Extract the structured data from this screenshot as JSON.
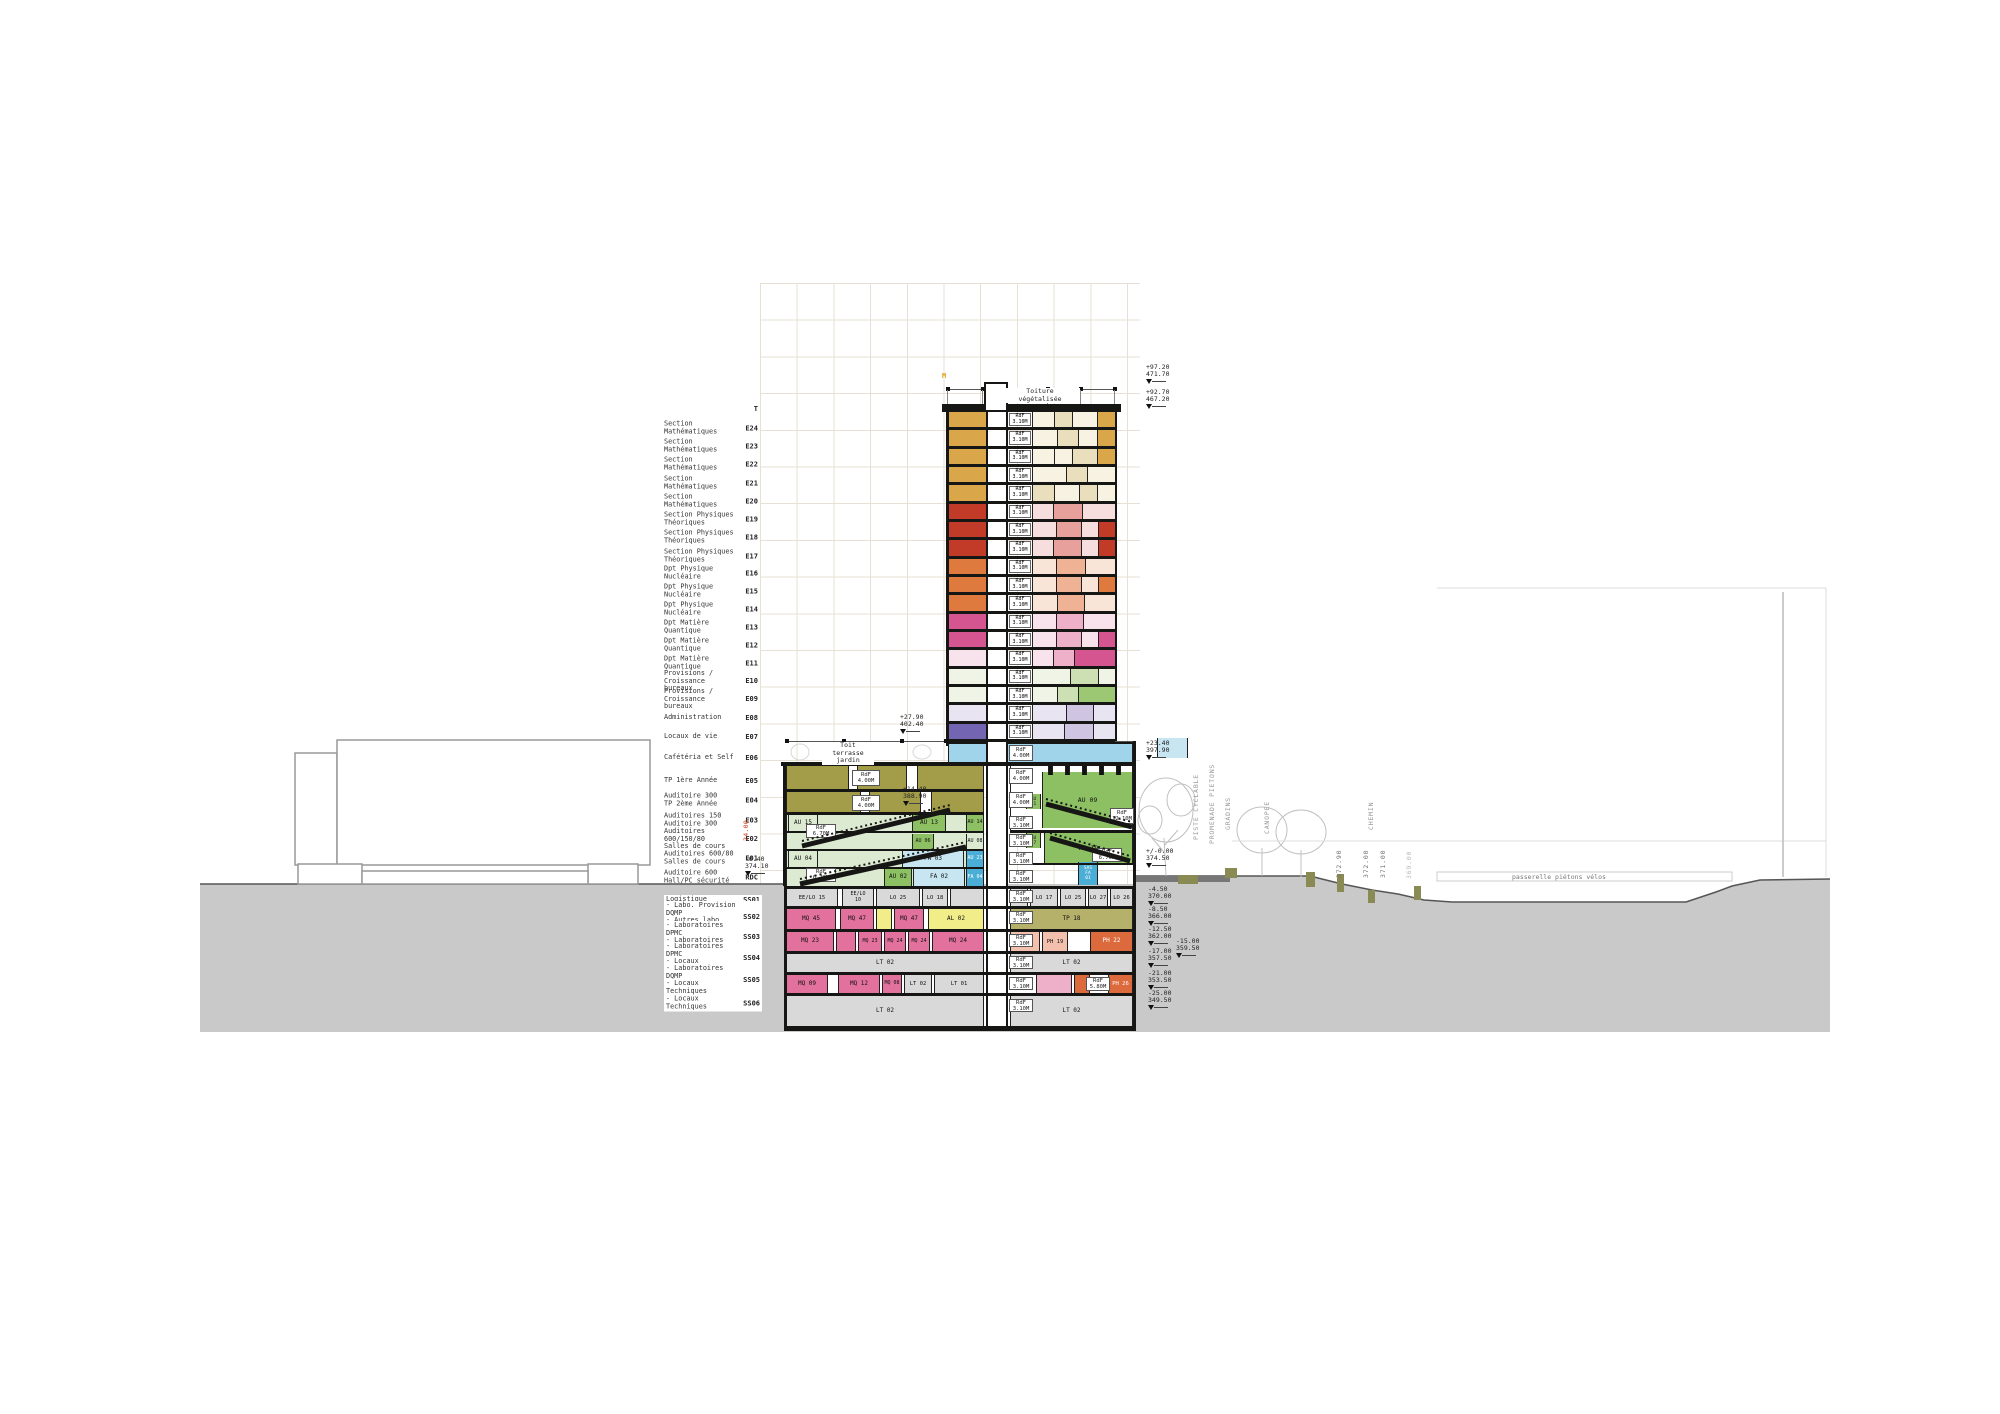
{
  "colors": {
    "gold": "#d9a64a",
    "tan": "#e9dfbc",
    "cream": "#f7f2e2",
    "red": "#c23a28",
    "rose": "#e7a09c",
    "pinkL": "#f7dede",
    "orange": "#df7a3e",
    "sal": "#f0b294",
    "salL": "#f9e4d8",
    "magenta": "#d45590",
    "pk": "#eeafc9",
    "pkL": "#f8e2ec",
    "green": "#9dc873",
    "grnM": "#cde0b4",
    "grnL": "#eff4e6",
    "lav": "#cfc5e2",
    "lavL": "#e8e4f2",
    "purple": "#7465b2",
    "blue": "#9fd4ea",
    "blueD": "#4aaed6",
    "blueM": "#c8e6f2",
    "olive": "#a39d4a",
    "oliveL": "#b5b06a",
    "paleGrn": "#dcead2",
    "auGreen": "#8cc063",
    "pinkLab": "#e2719d",
    "yellow": "#f1ee8a",
    "phOr": "#dd6a3d",
    "phSal": "#f2c0ac",
    "grayRoom": "#d9d9d9",
    "white": "#ffffff",
    "black": "#111111",
    "ground": "#c9c9c9",
    "accentOrange": "#e8a020",
    "dimRed": "#cc4422"
  },
  "floor_labels": [
    [
      409,
      "",
      "T"
    ],
    [
      428,
      "Section Mathématiques",
      "E24"
    ],
    [
      446,
      "Section Mathématiques",
      "E23"
    ],
    [
      464,
      "Section Mathématiques",
      "E22"
    ],
    [
      483,
      "Section Mathématiques",
      "E21"
    ],
    [
      501,
      "Section Mathématiques",
      "E20"
    ],
    [
      519,
      "Section Physiques\nThéoriques",
      "E19"
    ],
    [
      537,
      "Section Physiques\nThéoriques",
      "E18"
    ],
    [
      556,
      "Section Physiques\nThéoriques",
      "E17"
    ],
    [
      573,
      "Dpt Physique Nucléaire",
      "E16"
    ],
    [
      591,
      "Dpt Physique Nucléaire",
      "E15"
    ],
    [
      609,
      "Dpt Physique Nucléaire",
      "E14"
    ],
    [
      627,
      "Dpt Matière Quantique",
      "E13"
    ],
    [
      645,
      "Dpt Matière Quantique",
      "E12"
    ],
    [
      663,
      "Dpt Matière Quantique",
      "E11"
    ],
    [
      681,
      "Provisions / Croissance\nbureaux",
      "E10"
    ],
    [
      699,
      "Provisions / Croissance\nbureaux",
      "E09"
    ],
    [
      718,
      "Administration",
      "E08"
    ],
    [
      737,
      "Locaux de vie",
      "E07"
    ],
    [
      758,
      "Cafétéria et Self",
      "E06"
    ],
    [
      781,
      "TP 1ère Année",
      "E05"
    ],
    [
      800,
      "Auditoire 300\nTP 2ème Année",
      "E04"
    ],
    [
      820,
      "Auditoires 150\nAuditoire 300",
      "E03"
    ],
    [
      839,
      "Auditoires 600/150/80\nSalles de cours",
      "E02"
    ],
    [
      858,
      "Auditoires 600/80\nSalles de cours",
      "E01"
    ],
    [
      877,
      "Auditoire 600\nHall/PC sécurité",
      "RDC"
    ],
    [
      900,
      "Logistique",
      "SS01"
    ],
    [
      917,
      "- Labo. Provision DQMP\n- Autres labo\n- TP 3/4 Années",
      "SS02"
    ],
    [
      937,
      "- Laboratoires DPMC\n- Laboratoires DQMP",
      "SS03"
    ],
    [
      958,
      "- Laboratoires DPMC\n- Locaux techniques",
      "SS04"
    ],
    [
      980,
      "- Laboratoires DQMP\n- Locaux Techniques",
      "SS05"
    ],
    [
      1003,
      "- Locaux Techniques",
      "SS06"
    ]
  ],
  "tower": {
    "roof_label": "Toiture\nvégétalisée",
    "core_label": "RdF\n3.10M",
    "floors": [
      [
        "E24",
        "gold",
        [
          [
            0.26,
            "cream"
          ],
          [
            0.22,
            "tan"
          ],
          [
            0.3,
            "cream"
          ],
          [
            0.22,
            "gold"
          ]
        ]
      ],
      [
        "E23",
        "gold",
        [
          [
            0.3,
            "cream"
          ],
          [
            0.25,
            "tan"
          ],
          [
            0.23,
            "cream"
          ],
          [
            0.22,
            "gold"
          ]
        ]
      ],
      [
        "E22",
        "gold",
        [
          [
            0.26,
            "cream"
          ],
          [
            0.22,
            "cream"
          ],
          [
            0.3,
            "tan"
          ],
          [
            0.22,
            "gold"
          ]
        ]
      ],
      [
        "E21",
        "gold",
        [
          [
            0.4,
            "cream"
          ],
          [
            0.25,
            "tan"
          ],
          [
            0.35,
            "cream"
          ]
        ]
      ],
      [
        "E20",
        "gold",
        [
          [
            0.26,
            "tan"
          ],
          [
            0.3,
            "cream"
          ],
          [
            0.22,
            "tan"
          ],
          [
            0.22,
            "cream"
          ]
        ]
      ],
      [
        "E19",
        "red",
        [
          [
            0.25,
            "pinkL"
          ],
          [
            0.35,
            "rose"
          ],
          [
            0.4,
            "pinkL"
          ]
        ]
      ],
      [
        "E18",
        "red",
        [
          [
            0.28,
            "pinkL"
          ],
          [
            0.3,
            "rose"
          ],
          [
            0.2,
            "pinkL"
          ],
          [
            0.22,
            "red"
          ]
        ]
      ],
      [
        "E17",
        "red",
        [
          [
            0.25,
            "pinkL"
          ],
          [
            0.33,
            "rose"
          ],
          [
            0.2,
            "pinkL"
          ],
          [
            0.22,
            "red"
          ]
        ]
      ],
      [
        "E16",
        "orange",
        [
          [
            0.28,
            "salL"
          ],
          [
            0.34,
            "sal"
          ],
          [
            0.38,
            "salL"
          ]
        ]
      ],
      [
        "E15",
        "orange",
        [
          [
            0.28,
            "salL"
          ],
          [
            0.3,
            "sal"
          ],
          [
            0.2,
            "salL"
          ],
          [
            0.22,
            "orange"
          ]
        ]
      ],
      [
        "E14",
        "orange",
        [
          [
            0.3,
            "salL"
          ],
          [
            0.32,
            "sal"
          ],
          [
            0.38,
            "salL"
          ]
        ]
      ],
      [
        "E13",
        "magenta",
        [
          [
            0.28,
            "pkL"
          ],
          [
            0.32,
            "pk"
          ],
          [
            0.4,
            "pkL"
          ]
        ]
      ],
      [
        "E12",
        "magenta",
        [
          [
            0.28,
            "pkL"
          ],
          [
            0.3,
            "pk"
          ],
          [
            0.2,
            "pkL"
          ],
          [
            0.22,
            "magenta"
          ]
        ]
      ],
      [
        "E11",
        "pkL",
        [
          [
            0.25,
            "pkL"
          ],
          [
            0.25,
            "pk"
          ],
          [
            0.5,
            "magenta"
          ]
        ]
      ],
      [
        "E10",
        "grnL",
        [
          [
            0.45,
            "grnL"
          ],
          [
            0.33,
            "grnM"
          ],
          [
            0.22,
            "grnL"
          ]
        ]
      ],
      [
        "E09",
        "grnL",
        [
          [
            0.3,
            "grnL"
          ],
          [
            0.25,
            "grnM"
          ],
          [
            0.45,
            "green"
          ]
        ]
      ],
      [
        "E08",
        "lavL",
        [
          [
            0.4,
            "lavL"
          ],
          [
            0.32,
            "lav"
          ],
          [
            0.28,
            "lavL"
          ]
        ]
      ],
      [
        "E07",
        "purple",
        [
          [
            0.38,
            "lavL"
          ],
          [
            0.34,
            "lav"
          ],
          [
            0.28,
            "lavL"
          ]
        ]
      ]
    ]
  },
  "rooms": [
    [
      948,
      744,
      185,
      18,
      "blue",
      "",
      0,
      ""
    ],
    [
      786,
      766,
      198,
      23,
      "olive",
      "",
      0,
      ""
    ],
    [
      848,
      766,
      10,
      23,
      "white",
      "",
      0,
      ""
    ],
    [
      906,
      766,
      12,
      23,
      "white",
      "",
      0,
      ""
    ],
    [
      786,
      792,
      198,
      20,
      "olive",
      "",
      0,
      ""
    ],
    [
      860,
      792,
      10,
      20,
      "white",
      "",
      0,
      ""
    ],
    [
      920,
      792,
      12,
      20,
      "white",
      "",
      0,
      ""
    ],
    [
      786,
      815,
      198,
      16,
      "paleGrn",
      "",
      0,
      ""
    ],
    [
      788,
      815,
      30,
      16,
      "paleGrn",
      "AU 15",
      6,
      ""
    ],
    [
      912,
      815,
      34,
      16,
      "auGreen",
      "AU 13",
      6,
      ""
    ],
    [
      966,
      815,
      18,
      16,
      "auGreen",
      "AU 14",
      5,
      ""
    ],
    [
      786,
      833,
      198,
      16,
      "paleGrn",
      "",
      0,
      ""
    ],
    [
      912,
      834,
      22,
      15,
      "auGreen",
      "AU 06",
      5,
      ""
    ],
    [
      966,
      834,
      18,
      15,
      "paleGrn",
      "AU 08",
      5,
      ""
    ],
    [
      786,
      851,
      198,
      16,
      "paleGrn",
      "",
      0,
      ""
    ],
    [
      788,
      851,
      30,
      16,
      "paleGrn",
      "AU 04",
      6,
      ""
    ],
    [
      902,
      851,
      62,
      16,
      "blueM",
      "FA 03",
      6,
      ""
    ],
    [
      966,
      851,
      18,
      16,
      "blueD",
      "AU 23",
      5,
      "#fff"
    ],
    [
      786,
      869,
      198,
      17,
      "paleGrn",
      "",
      0,
      ""
    ],
    [
      884,
      869,
      28,
      17,
      "auGreen",
      "AU 02",
      6,
      ""
    ],
    [
      913,
      869,
      52,
      17,
      "blueM",
      "FA 02",
      6,
      ""
    ],
    [
      966,
      869,
      18,
      17,
      "blueD",
      "FA 04",
      5,
      "#fff"
    ],
    [
      1010,
      766,
      123,
      64,
      "white",
      "",
      0,
      ""
    ],
    [
      1042,
      772,
      91,
      56,
      "auGreen",
      "AU 09",
      6.5,
      ""
    ],
    [
      1026,
      794,
      15,
      15,
      "auGreen",
      "AU\n11",
      4.5,
      ""
    ],
    [
      1048,
      766,
      5,
      9,
      "black",
      "",
      0,
      ""
    ],
    [
      1065,
      766,
      5,
      9,
      "black",
      "",
      0,
      ""
    ],
    [
      1082,
      766,
      5,
      9,
      "black",
      "",
      0,
      ""
    ],
    [
      1099,
      766,
      5,
      9,
      "black",
      "",
      0,
      ""
    ],
    [
      1116,
      766,
      5,
      9,
      "black",
      "",
      0,
      ""
    ],
    [
      1026,
      833,
      15,
      15,
      "auGreen",
      "AU\n17",
      4.5,
      ""
    ],
    [
      1044,
      833,
      89,
      30,
      "auGreen",
      "AU 19",
      6.5,
      ""
    ],
    [
      1078,
      862,
      20,
      23,
      "blueD",
      "SAS\nFA\n01",
      4.5,
      "#fff"
    ],
    [
      1157,
      738,
      31,
      20,
      "blueM",
      "",
      0,
      ""
    ],
    [
      786,
      889,
      52,
      17,
      "grayRoom",
      "EE/LO 15",
      5.5,
      ""
    ],
    [
      842,
      889,
      32,
      17,
      "grayRoom",
      "EE/LO\n10",
      5,
      ""
    ],
    [
      876,
      889,
      44,
      17,
      "grayRoom",
      "LO 25",
      5.5,
      ""
    ],
    [
      922,
      889,
      26,
      17,
      "grayRoom",
      "LO 18",
      5.5,
      ""
    ],
    [
      950,
      889,
      34,
      17,
      "grayRoom",
      "",
      0,
      ""
    ],
    [
      1010,
      889,
      18,
      17,
      "grayRoom",
      "",
      0,
      ""
    ],
    [
      1030,
      889,
      28,
      17,
      "grayRoom",
      "LO 17",
      5.5,
      ""
    ],
    [
      1060,
      889,
      26,
      17,
      "grayRoom",
      "LO 25",
      5.5,
      ""
    ],
    [
      1088,
      889,
      20,
      17,
      "grayRoom",
      "LO 27",
      5.5,
      ""
    ],
    [
      1110,
      889,
      23,
      17,
      "grayRoom",
      "LO 26",
      5.5,
      ""
    ],
    [
      786,
      909,
      50,
      20,
      "pinkLab",
      "MQ 45",
      6,
      ""
    ],
    [
      840,
      909,
      34,
      20,
      "pinkLab",
      "MQ 47",
      6,
      ""
    ],
    [
      876,
      909,
      16,
      20,
      "yellow",
      "",
      0,
      ""
    ],
    [
      894,
      909,
      30,
      20,
      "pinkLab",
      "MQ 47",
      6,
      ""
    ],
    [
      928,
      909,
      56,
      20,
      "yellow",
      "AL 02",
      6,
      ""
    ],
    [
      1010,
      909,
      123,
      20,
      "oliveL",
      "TP 18",
      6,
      ""
    ],
    [
      786,
      932,
      48,
      19,
      "pinkLab",
      "MQ 23",
      6,
      ""
    ],
    [
      836,
      932,
      20,
      19,
      "pinkLab",
      "",
      0,
      ""
    ],
    [
      858,
      932,
      24,
      19,
      "pinkLab",
      "MQ 23",
      5,
      ""
    ],
    [
      884,
      932,
      22,
      19,
      "pinkLab",
      "MQ 24",
      5,
      ""
    ],
    [
      908,
      932,
      22,
      19,
      "pinkLab",
      "MQ 24",
      5,
      ""
    ],
    [
      932,
      932,
      52,
      19,
      "pinkLab",
      "MQ 24",
      6,
      ""
    ],
    [
      1010,
      932,
      30,
      19,
      "phSal",
      "",
      0,
      ""
    ],
    [
      1042,
      932,
      26,
      19,
      "phSal",
      "PH 19",
      5.5,
      ""
    ],
    [
      1090,
      932,
      43,
      19,
      "phOr",
      "PH 22",
      6,
      "#fff"
    ],
    [
      786,
      954,
      198,
      18,
      "grayRoom",
      "LT 02",
      6,
      ""
    ],
    [
      1010,
      954,
      123,
      18,
      "grayRoom",
      "LT 02",
      6,
      ""
    ],
    [
      786,
      975,
      42,
      18,
      "pinkLab",
      "MQ 09",
      6,
      ""
    ],
    [
      838,
      975,
      42,
      18,
      "pinkLab",
      "MQ 12",
      6,
      ""
    ],
    [
      882,
      975,
      20,
      18,
      "pinkLab",
      "MQ 08",
      5,
      ""
    ],
    [
      904,
      975,
      28,
      18,
      "grayRoom",
      "LT 02",
      5.5,
      ""
    ],
    [
      934,
      975,
      50,
      18,
      "grayRoom",
      "LT 01",
      5.5,
      ""
    ],
    [
      1036,
      975,
      36,
      18,
      "pk",
      "",
      0,
      ""
    ],
    [
      1074,
      975,
      16,
      18,
      "phOr",
      "",
      0,
      ""
    ],
    [
      1108,
      975,
      25,
      18,
      "phOr",
      "PH 26",
      5.5,
      "#fff"
    ],
    [
      786,
      996,
      198,
      30,
      "grayRoom",
      "LT 02",
      6,
      ""
    ],
    [
      1010,
      996,
      123,
      30,
      "grayRoom",
      "LT 02",
      6,
      ""
    ]
  ],
  "core_labels": [
    [
      1009,
      745,
      24,
      16,
      "RdF\n4.00M"
    ],
    [
      1009,
      768,
      24,
      16,
      "RdF\n4.00M"
    ],
    [
      1009,
      792,
      24,
      16,
      "RdF\n4.00M"
    ],
    [
      1009,
      816,
      24,
      13,
      "RdF\n3.10M"
    ],
    [
      1009,
      834,
      24,
      13,
      "RdF\n3.10M"
    ],
    [
      1009,
      852,
      24,
      13,
      "RdF\n3.10M"
    ],
    [
      1009,
      870,
      24,
      13,
      "RdF\n3.10M"
    ],
    [
      1009,
      890,
      24,
      13,
      "RdF\n3.10M"
    ],
    [
      1009,
      911,
      24,
      13,
      "RdF\n3.10M"
    ],
    [
      1009,
      934,
      24,
      13,
      "RdF\n3.10M"
    ],
    [
      1009,
      956,
      24,
      13,
      "RdF\n3.10M"
    ],
    [
      1009,
      977,
      24,
      13,
      "RdF\n3.10M"
    ],
    [
      1009,
      999,
      24,
      13,
      "RdF\n3.10M"
    ],
    [
      852,
      770,
      28,
      16,
      "RdF\n4.00M"
    ],
    [
      852,
      795,
      28,
      16,
      "RdF\n4.00M"
    ],
    [
      806,
      824,
      30,
      14,
      "RdF\n6.70M"
    ],
    [
      806,
      868,
      30,
      14,
      "RdF\n6.70M"
    ],
    [
      1110,
      808,
      24,
      16,
      "RdF\n12.10M"
    ],
    [
      1092,
      848,
      30,
      14,
      "RdF\n6.70M"
    ],
    [
      1086,
      977,
      24,
      14,
      "RdF\n5.80M"
    ]
  ],
  "elevation_markers": [
    [
      1146,
      364,
      "+97.20",
      "471.70"
    ],
    [
      1146,
      389,
      "+92.70",
      "467.20"
    ],
    [
      1146,
      740,
      "+23.40",
      "397.90"
    ],
    [
      1146,
      848,
      "+/-0.00",
      "374.50"
    ],
    [
      1148,
      886,
      "-4.50",
      "370.00"
    ],
    [
      1148,
      906,
      "-8.50",
      "366.00"
    ],
    [
      1148,
      926,
      "-12.50",
      "362.00"
    ],
    [
      1176,
      938,
      "-15.00",
      "359.50"
    ],
    [
      1148,
      948,
      "-17.00",
      "357.50"
    ],
    [
      1148,
      970,
      "-21.00",
      "353.50"
    ],
    [
      1148,
      990,
      "-25.00",
      "349.50"
    ],
    [
      900,
      714,
      "+27.90",
      "402.40"
    ],
    [
      903,
      786,
      "+14.40",
      "388.90"
    ],
    [
      745,
      856,
      "-0.40",
      "374.10"
    ]
  ],
  "site": {
    "rotated_labels": [
      [
        1200,
        832,
        "PISTE CYCLABLE",
        "#999"
      ],
      [
        1216,
        836,
        "PROMENADE PIETONS",
        "#999"
      ],
      [
        1232,
        822,
        "GRADINS",
        "#999"
      ],
      [
        1271,
        826,
        "CANOPEE",
        "#999"
      ],
      [
        1375,
        822,
        "CHEMIN",
        "#999"
      ],
      [
        1343,
        870,
        "372.90",
        "#777"
      ],
      [
        1370,
        870,
        "372.00",
        "#777"
      ],
      [
        1387,
        870,
        "371.00",
        "#777"
      ],
      [
        1413,
        871,
        "369.00",
        "#bbb"
      ]
    ],
    "passerelle_label": "passerelle piétons vélos"
  },
  "misc": {
    "toit_terrasse": "Toit\nterrasse\njardin",
    "grid_mark": "M",
    "dim_label": "24.00"
  }
}
